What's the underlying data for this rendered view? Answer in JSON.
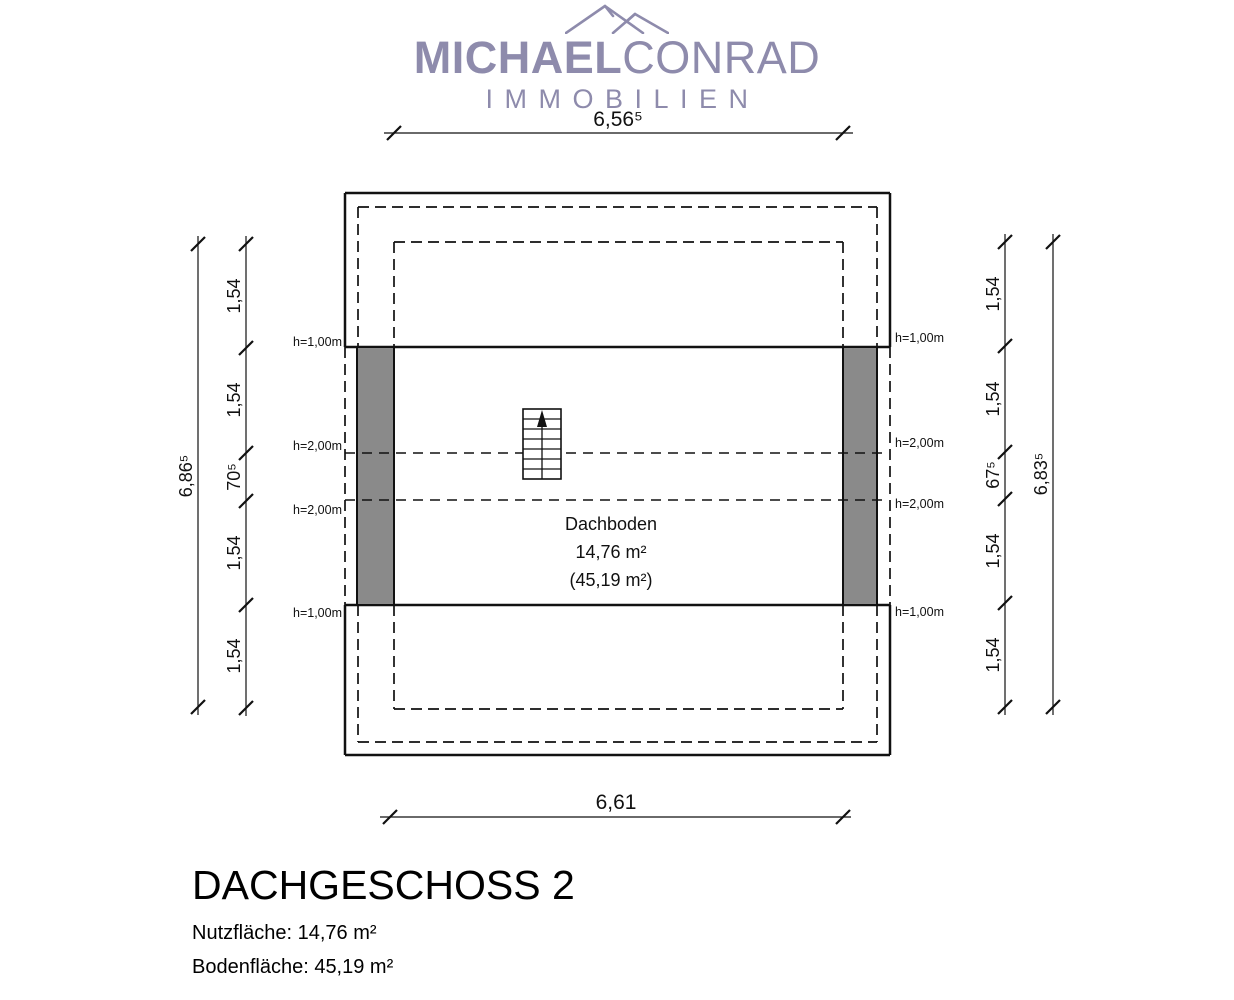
{
  "logo": {
    "brand_bold": "MICHAEL",
    "brand_regular": "CONRAD",
    "subtitle": "IMMOBILIEN",
    "color": "#8e8bac"
  },
  "plan": {
    "room": {
      "name": "Dachboden",
      "area_usable": "14,76 m²",
      "area_floor": "(45,19 m²)"
    },
    "height_labels": {
      "left": [
        "h=1,00m",
        "h=2,00m",
        "h=2,00m",
        "h=1,00m"
      ],
      "right": [
        "h=1,00m",
        "h=2,00m",
        "h=2,00m",
        "h=1,00m"
      ]
    },
    "dimensions": {
      "top_width": "6,56⁵",
      "bottom_width": "6,61",
      "left_total": "6,86⁵",
      "left_segments": [
        "1,54",
        "1,54",
        "70⁵",
        "1,54",
        "1,54"
      ],
      "right_total": "6,83⁵",
      "right_segments": [
        "1,54",
        "1,54",
        "67⁵",
        "1,54",
        "1,54"
      ]
    },
    "colors": {
      "wall_fill": "#8a8a8a",
      "line": "#111111"
    }
  },
  "footer": {
    "title": "DACHGESCHOSS 2",
    "usable_area": "Nutzfläche: 14,76 m²",
    "floor_area": "Bodenfläche: 45,19 m²"
  }
}
